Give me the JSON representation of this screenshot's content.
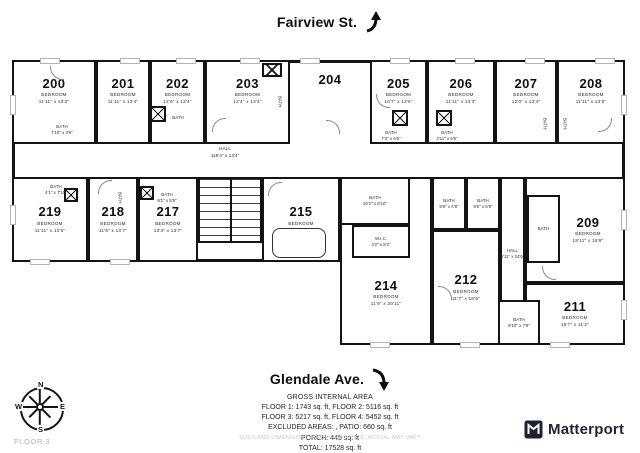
{
  "streets": {
    "top": "Fairview St.",
    "bottom": "Glendale Ave."
  },
  "compass": {
    "n": "N",
    "e": "E",
    "s": "S",
    "w": "W"
  },
  "floor_label": "FLOOR 3",
  "brand": {
    "name": "Matterport"
  },
  "area_summary": {
    "title": "GROSS INTERNAL AREA",
    "line1": "FLOOR 1: 1743 sq. ft, FLOOR 2: 5116 sq. ft",
    "line2": "FLOOR 3: 5217 sq. ft, FLOOR 4: 5452 sq. ft",
    "line3": "EXCLUDED AREAS: , PATIO: 660 sq. ft",
    "line4": "PORCH: 445 sq. ft",
    "line5": "TOTAL: 17528 sq. ft",
    "disclaimer": "SIZES AND DIMENSIONS ARE APPROXIMATE, ACTUAL MAY VARY"
  },
  "halls": {
    "main": {
      "label": "HALL",
      "dims": "119'4\" x 13'4\""
    },
    "right": {
      "label": "HALL",
      "dims": "6'11\" x 24'6\""
    }
  },
  "rooms": [
    {
      "number": "200",
      "type": "BEDROOM",
      "dims": "11'11\" x 13'3\""
    },
    {
      "number": "201",
      "type": "BEDROOM",
      "dims": "11'11\" x 13'4\""
    },
    {
      "number": "202",
      "type": "BEDROOM",
      "dims": "12'0\" x 13'4\""
    },
    {
      "number": "203",
      "type": "BEDROOM",
      "dims": "12'4\" x 13'4\""
    },
    {
      "number": "204",
      "type": "",
      "dims": ""
    },
    {
      "number": "205",
      "type": "BEDROOM",
      "dims": "10'7\" x 13'6\""
    },
    {
      "number": "206",
      "type": "BEDROOM",
      "dims": "11'11\" x 13'3\""
    },
    {
      "number": "207",
      "type": "BEDROOM",
      "dims": "12'0\" x 13'4\""
    },
    {
      "number": "208",
      "type": "BEDROOM",
      "dims": "11'11\" x 13'5\""
    },
    {
      "number": "219",
      "type": "BEDROOM",
      "dims": "11'11\" x 13'5\""
    },
    {
      "number": "218",
      "type": "BEDROOM",
      "dims": "11'5\" x 13'7\""
    },
    {
      "number": "217",
      "type": "BEDROOM",
      "dims": "13'3\" x 13'7\""
    },
    {
      "number": "215",
      "type": "BEDROOM",
      "dims": "21'5\" x 13'6\""
    },
    {
      "number": "214",
      "type": "BEDROOM",
      "dims": "11'9\" x 30'11\""
    },
    {
      "number": "212",
      "type": "BEDROOM",
      "dims": "11'7\" x 16'9\""
    },
    {
      "number": "211",
      "type": "BEDROOM",
      "dims": "16'7\" x 11'2\""
    },
    {
      "number": "209",
      "type": "BEDROOM",
      "dims": "18'11\" x 19'9\""
    }
  ],
  "baths": {
    "b200": {
      "label": "BATH",
      "dims": "7'10\" x 3'6\""
    },
    "b202": {
      "label": "BATH",
      "dims": ""
    },
    "b203": {
      "label": "BATH",
      "dims": ""
    },
    "b205": {
      "label": "BATH",
      "dims": "7'3\" x 6'6\""
    },
    "b206": {
      "label": "BATH",
      "dims": "4'11\" x 6'5\""
    },
    "b207": {
      "label": "BATH",
      "dims": ""
    },
    "b208": {
      "label": "BATH",
      "dims": ""
    },
    "b219": {
      "label": "BATH",
      "dims": "4'1\" x 7'10\""
    },
    "b218": {
      "label": "BATH",
      "dims": ""
    },
    "b217": {
      "label": "BATH",
      "dims": "9'1\" x 5'9\""
    },
    "b215": {
      "label": "BATH",
      "dims": "10'2\" x 8'10\""
    },
    "wic": {
      "label": "W.I.C.",
      "dims": "4'2\" x 8'2\""
    },
    "b212a": {
      "label": "BATH",
      "dims": "9'9\" x 4'8\""
    },
    "b212b": {
      "label": "BATH",
      "dims": "9'6\" x 5'9\""
    },
    "b209": {
      "label": "BATH",
      "dims": ""
    },
    "b211": {
      "label": "BATH",
      "dims": "9'10\" x 7'9\""
    }
  }
}
